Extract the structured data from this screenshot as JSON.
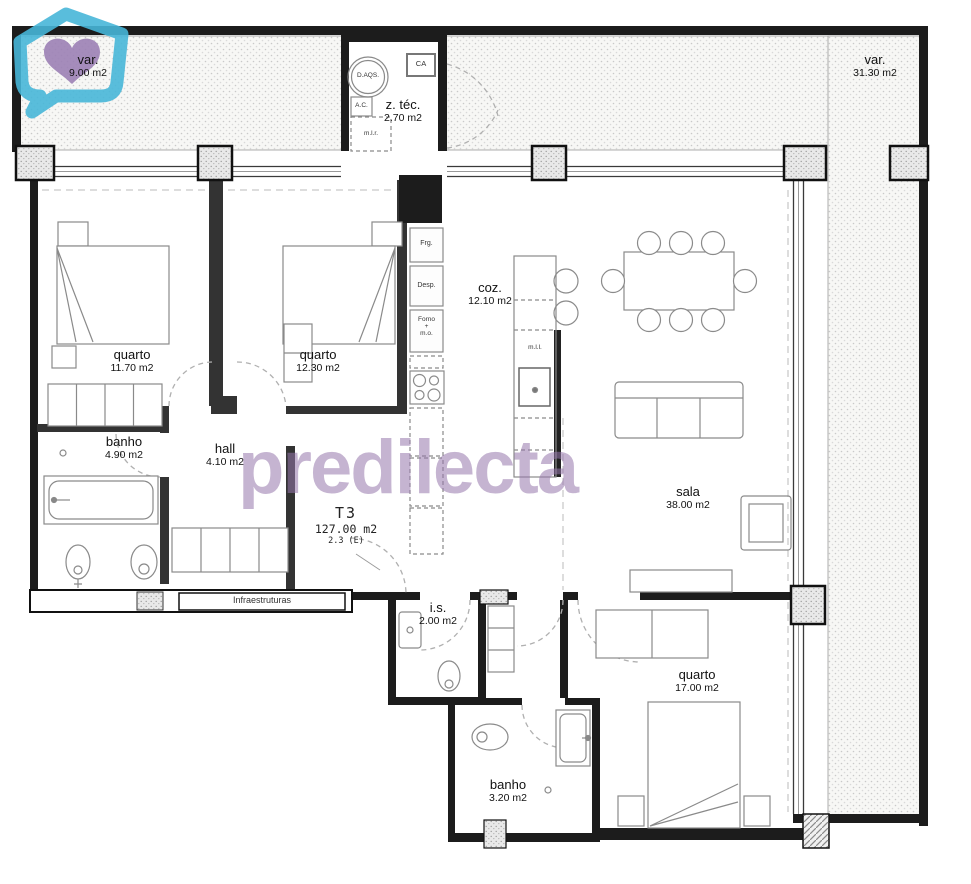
{
  "plan": {
    "unit": {
      "type_label": "T3",
      "total_area": "127.00 m2",
      "note": "2.3 (E)"
    },
    "watermark": {
      "brand": "predilecta"
    },
    "rooms": [
      {
        "id": "var-left",
        "name": "var.",
        "area": "9.00 m2"
      },
      {
        "id": "var-right",
        "name": "var.",
        "area": "31.30 m2"
      },
      {
        "id": "ztec",
        "name": "z. téc.",
        "area": "2.70 m2"
      },
      {
        "id": "quarto-1",
        "name": "quarto",
        "area": "11.70 m2"
      },
      {
        "id": "quarto-2",
        "name": "quarto",
        "area": "12.30 m2"
      },
      {
        "id": "banho-1",
        "name": "banho",
        "area": "4.90 m2"
      },
      {
        "id": "hall",
        "name": "hall",
        "area": "4.10 m2"
      },
      {
        "id": "coz",
        "name": "coz.",
        "area": "12.10 m2"
      },
      {
        "id": "sala",
        "name": "sala",
        "area": "38.00 m2"
      },
      {
        "id": "is",
        "name": "i.s.",
        "area": "2.00 m2"
      },
      {
        "id": "quarto-3",
        "name": "quarto",
        "area": "17.00 m2"
      },
      {
        "id": "banho-2",
        "name": "banho",
        "area": "3.20 m2"
      }
    ],
    "equipment_labels": {
      "daqs": "D.AQS.",
      "ca": "CA",
      "ac": "A.C.",
      "mlr": "m.l.r.",
      "frg": "Frg.",
      "desp": "Desp.",
      "forno": "Forno\n+\nm.o.",
      "mll": "m.l.l.",
      "infra": "Infraestruturas"
    },
    "colors": {
      "walls": "#1c1c1c",
      "brand_teal": "#47b6d8",
      "brand_purple": "#9b80b5",
      "watermark_text": "#b4a0c8"
    }
  }
}
